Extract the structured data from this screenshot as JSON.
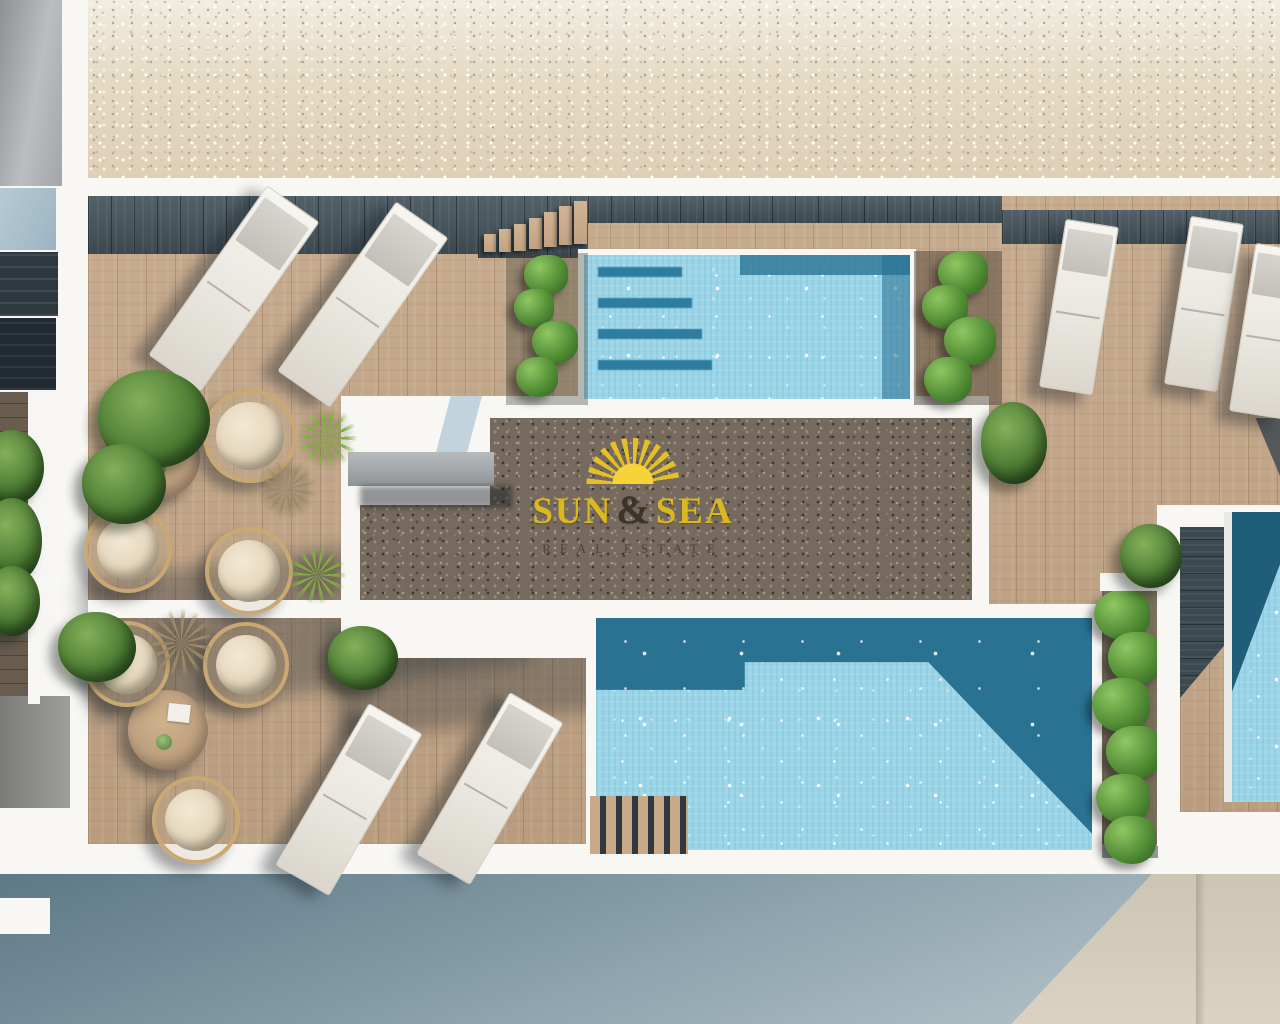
{
  "watermark": {
    "word1": "SUN",
    "ampersand": "&",
    "word2": "SEA",
    "tagline": "REAL ESTATE"
  },
  "palette": {
    "logo_gold": "#dcb81f",
    "logo_dark": "#3b342a",
    "pool_water_light": "#9cd5e7",
    "pool_water_deep": "#2a7291",
    "deck_wood": "#c3a586",
    "dark_walkway": "#44535b",
    "gravel_light": "#e4dac4",
    "gravel_dark": "#756a5d",
    "street_shadow": "#5d7886",
    "street_sunlit": "#d5cdbd",
    "plant_green": "#4f8a33"
  },
  "scene": {
    "view": "top-down aerial 3D architectural rendering",
    "elements": [
      "beige gravel roof strip",
      "wooden roof terrace deck",
      "upper swimming pool with underwater steps",
      "lower swimming pool with wooden steps",
      "right edge swimming pool",
      "sun loungers",
      "round rattan egg chairs",
      "round wooden tables",
      "green bushes and climbing plants",
      "central dark gravel platform with developer watermark"
    ]
  }
}
